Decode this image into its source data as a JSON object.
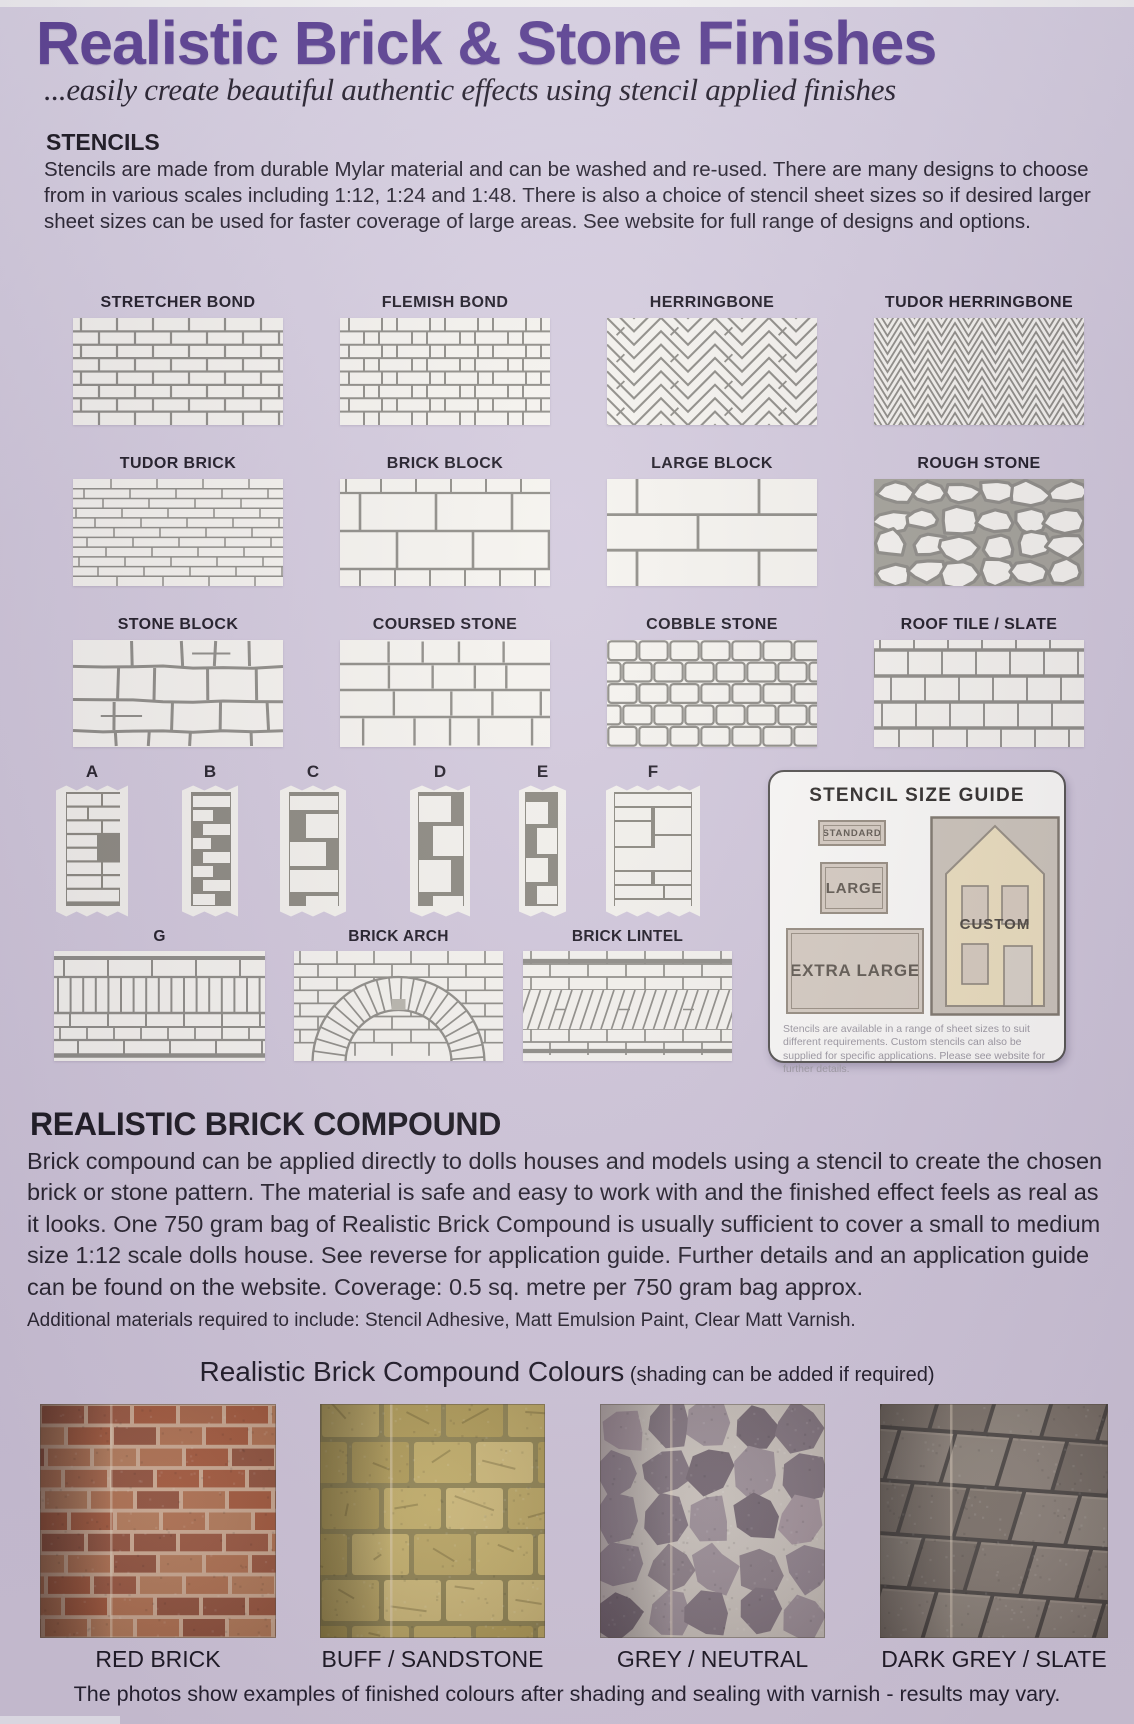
{
  "page": {
    "title": "Realistic Brick & Stone Finishes",
    "title_color": "#5a3f92",
    "background_color": "#d2c9dc",
    "subtitle": "...easily create beautiful authentic effects using stencil applied finishes"
  },
  "stencils_section": {
    "heading": "STENCILS",
    "body": "Stencils are made from durable Mylar material and can be washed and re-used.  There are many designs to choose from in various scales including 1:12, 1:24 and 1:48.  There is also a choice of stencil sheet sizes so if desired larger sheet sizes can be used for faster coverage of large areas.  See website for full range of designs and options."
  },
  "swatch_style": {
    "paper": "#f5f3ee",
    "line": "#8d8b85"
  },
  "patterns": [
    {
      "label": "STRETCHER BOND",
      "type": "stretcher"
    },
    {
      "label": "FLEMISH BOND",
      "type": "flemish"
    },
    {
      "label": "HERRINGBONE",
      "type": "herringbone"
    },
    {
      "label": "TUDOR HERRINGBONE",
      "type": "tudor-herringbone"
    },
    {
      "label": "TUDOR BRICK",
      "type": "tudor-brick"
    },
    {
      "label": "BRICK BLOCK",
      "type": "brick-block"
    },
    {
      "label": "LARGE BLOCK",
      "type": "large-block"
    },
    {
      "label": "ROUGH STONE",
      "type": "rough-stone"
    },
    {
      "label": "STONE BLOCK",
      "type": "stone-block"
    },
    {
      "label": "COURSED STONE",
      "type": "coursed-stone"
    },
    {
      "label": "COBBLE STONE",
      "type": "cobble-stone"
    },
    {
      "label": "ROOF TILE / SLATE",
      "type": "roof-tile"
    }
  ],
  "corner_samples": [
    {
      "label": "A"
    },
    {
      "label": "B"
    },
    {
      "label": "C"
    },
    {
      "label": "D"
    },
    {
      "label": "E"
    },
    {
      "label": "F"
    }
  ],
  "feature_samples": [
    {
      "label": "G",
      "type": "band"
    },
    {
      "label": "BRICK ARCH",
      "type": "arch"
    },
    {
      "label": "BRICK LINTEL",
      "type": "lintel"
    }
  ],
  "size_guide": {
    "title": "STENCIL SIZE GUIDE",
    "sizes": [
      "STANDARD",
      "LARGE",
      "EXTRA LARGE"
    ],
    "custom_label": "CUSTOM",
    "note": "Stencils are available in a range of sheet sizes to suit different requirements.  Custom stencils can also be supplied for specific applications. Please see website for further details."
  },
  "compound_section": {
    "heading": "REALISTIC BRICK COMPOUND",
    "body": "Brick compound can be applied directly to dolls houses and models using a stencil to create the chosen brick or stone pattern.  The material is safe and easy to work with and the finished effect feels as real as it looks.  One 750 gram bag of Realistic Brick Compound is usually sufficient to cover a small to medium size 1:12 scale dolls house.  See reverse for application guide.  Further details and an application guide  can be found on the website. Coverage: 0.5 sq. metre per 750 gram bag approx.",
    "additional": "Additional materials required to  include: Stencil Adhesive, Matt Emulsion Paint, Clear Matt Varnish."
  },
  "colours_section": {
    "title": "Realistic Brick Compound Colours",
    "note": " (shading can be added if required)",
    "swatches": [
      {
        "label": "RED BRICK",
        "type": "red-brick",
        "mortar": "#cfa98c",
        "palette": [
          "#a3512f",
          "#b06b45",
          "#8f4a30",
          "#a75e3b",
          "#b4764f",
          "#984f33"
        ]
      },
      {
        "label": "BUFF / SANDSTONE",
        "type": "buff-sandstone",
        "mortar": "#8d8048",
        "palette": [
          "#c7b163",
          "#bca65a",
          "#d0ba71",
          "#b09a4d",
          "#c3ad5f"
        ]
      },
      {
        "label": "GREY / NEUTRAL",
        "type": "grey-neutral",
        "mortar": "#cbc3ba",
        "palette": [
          "#8e8089",
          "#998b92",
          "#7c6e77",
          "#a39299",
          "#6e6069",
          "#887a81"
        ]
      },
      {
        "label": "DARK GREY / SLATE",
        "type": "dark-grey-slate",
        "mortar": "#403b35",
        "palette": [
          "#7e7367",
          "#877c70",
          "#6f655a",
          "#8a8073",
          "#776c60"
        ]
      }
    ],
    "footnote": "The photos show examples of finished colours after shading and sealing with varnish - results may vary."
  }
}
